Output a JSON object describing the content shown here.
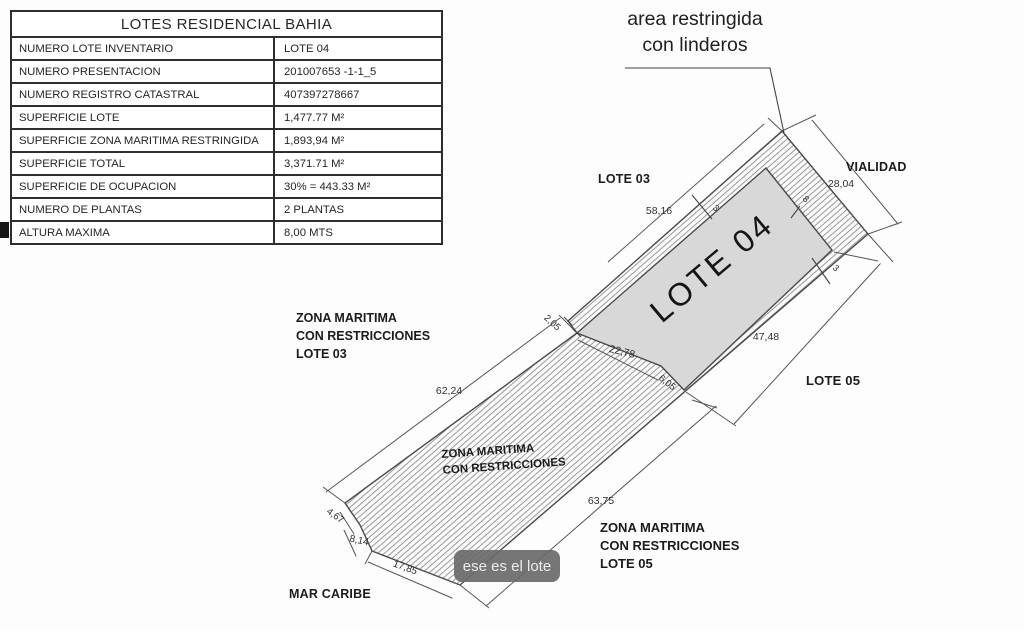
{
  "table": {
    "title": "LOTES RESIDENCIAL BAHIA",
    "rows": [
      {
        "label": "NUMERO LOTE INVENTARIO",
        "value": "LOTE 04"
      },
      {
        "label": "NUMERO PRESENTACION",
        "value": "201007653 -1-1_5"
      },
      {
        "label": "NUMERO REGISTRO CATASTRAL",
        "value": "407397278667"
      },
      {
        "label": "SUPERFICIE LOTE",
        "value": "1,477.77 M²"
      },
      {
        "label": "SUPERFICIE ZONA MARITIMA RESTRINGIDA",
        "value": "1,893,94 M²"
      },
      {
        "label": "SUPERFICIE TOTAL",
        "value": "3,371.71 M²"
      },
      {
        "label": "SUPERFICIE DE OCUPACION",
        "value": "30% = 443.33 M²"
      },
      {
        "label": "NUMERO DE PLANTAS",
        "value": "2 PLANTAS"
      },
      {
        "label": "ALTURA MAXIMA",
        "value": "8,00 MTS"
      }
    ]
  },
  "callout": {
    "line1": "area restringida",
    "line2": "con linderos"
  },
  "plan": {
    "lot03": "LOTE 03",
    "vialidad": "VIALIDAD",
    "lot04": "LOTE 04",
    "lot05": "LOTE 05",
    "mar_caribe": "MAR CARIBE",
    "zona03": {
      "l1": "ZONA MARITIMA",
      "l2": "CON RESTRICCIONES",
      "l3": "LOTE 03"
    },
    "zona_mid": {
      "l1": "ZONA MARITIMA",
      "l2": "CON RESTRICCIONES"
    },
    "zona05": {
      "l1": "ZONA MARITIMA",
      "l2": "CON RESTRICCIONES",
      "l3": "LOTE 05"
    }
  },
  "dims": {
    "edge_58": "58,16",
    "road_28": "28,04",
    "left_62": "62,24",
    "notch_2": "2,05",
    "mid_22": "22,78",
    "small_6": "6,05",
    "lot_47": "47,48",
    "sea_63": "63,75",
    "jog_4": "4,67",
    "jog_8": "8,14",
    "jog_17": "17,85",
    "strip_8": "8",
    "strip_3a": "3",
    "strip_3b": "3"
  },
  "tooltip": {
    "text": "ese es el lote"
  },
  "colors": {
    "lot_fill": "#d8d8d8",
    "hatch_line": "#8f8f8f",
    "outline": "#4a4a4a",
    "dim_line": "#555555",
    "tooltip_bg": "#6a6a6a",
    "tooltip_text": "#ededed"
  }
}
